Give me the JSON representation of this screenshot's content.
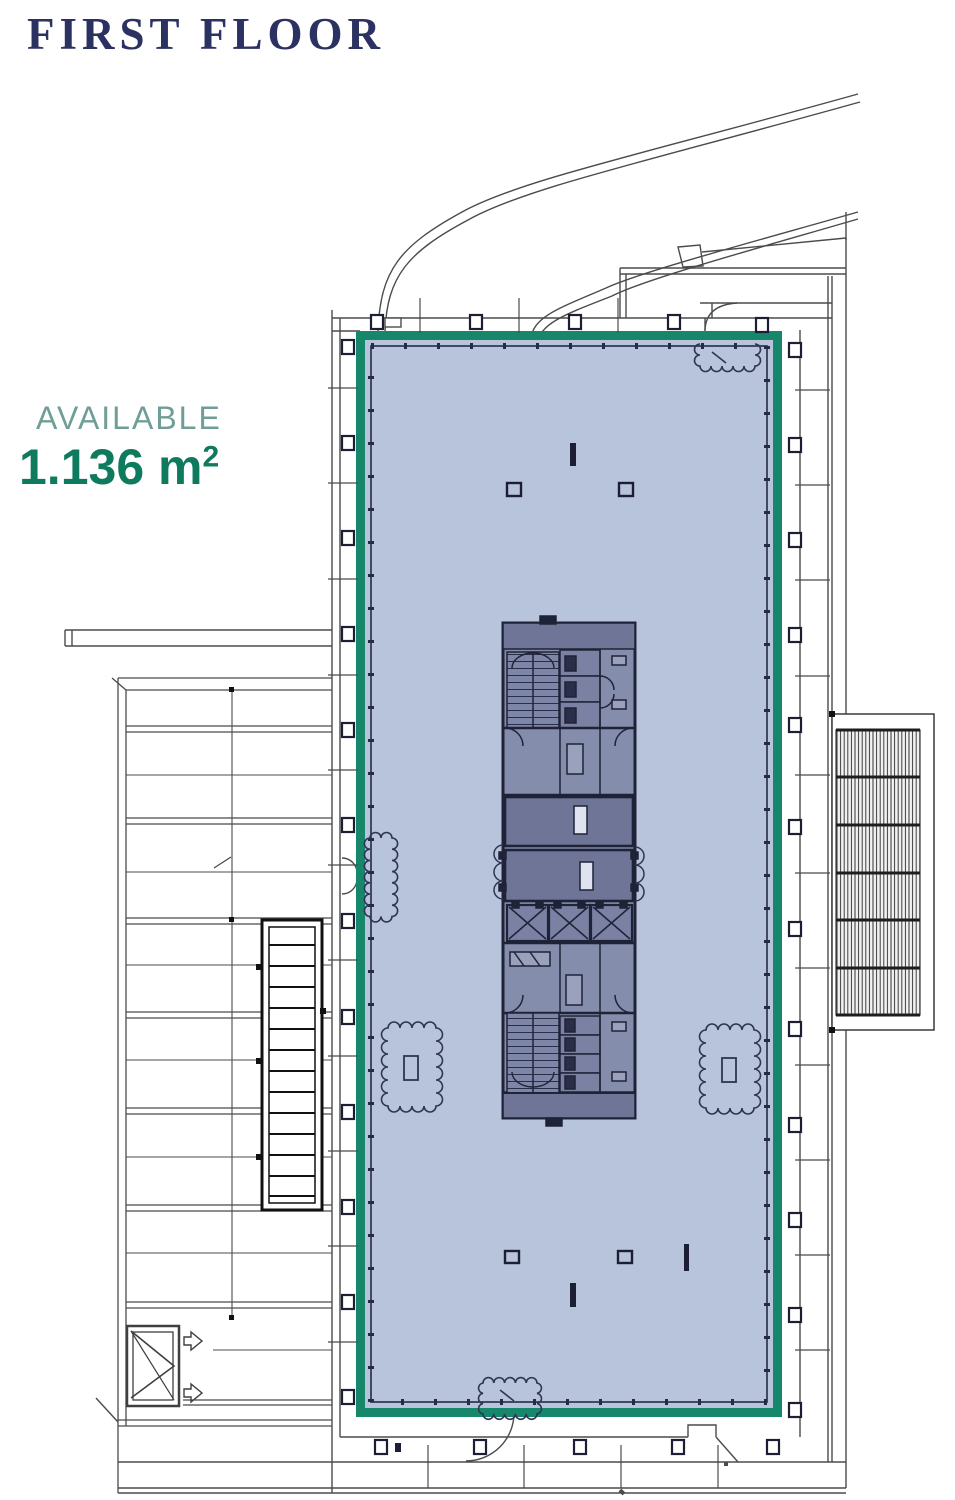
{
  "header": {
    "title": "FIRST FLOOR",
    "title_color": "#2b3261"
  },
  "availability": {
    "label": "AVAILABLE",
    "label_color": "#6f9e99",
    "area_value": "1.136 m",
    "area_superscript": "2",
    "area_color": "#0f7b5e"
  },
  "plan": {
    "available_space": {
      "status": "AVAILABLE",
      "area_sqm": "1.136"
    },
    "colors": {
      "highlight_border": "#17876b",
      "highlight_fill": "#b8c3dc",
      "core_fill": "#858dac",
      "core_dark": "#6e7596",
      "line": "#3f3f3f"
    }
  }
}
